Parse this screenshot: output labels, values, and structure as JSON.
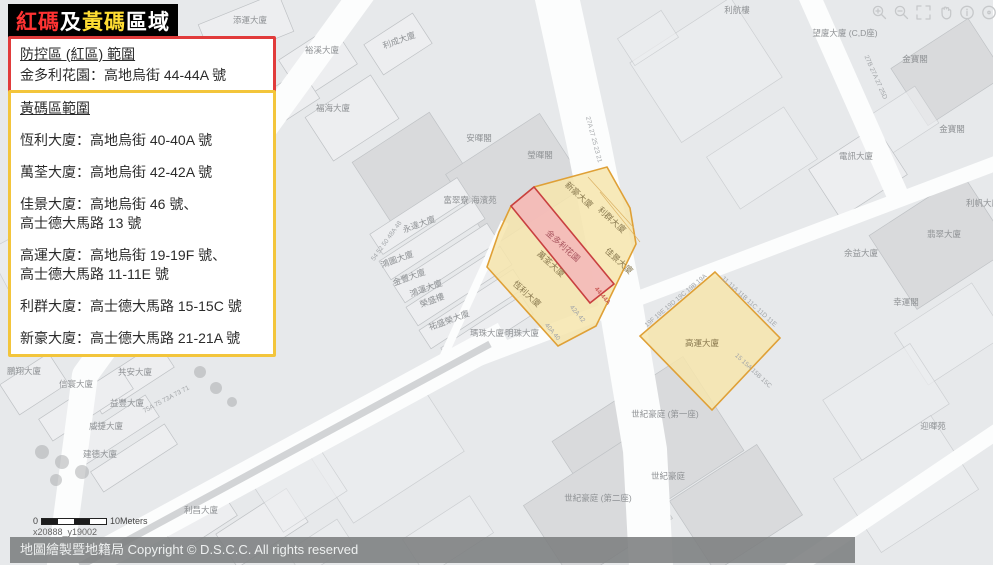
{
  "colors": {
    "map_bg": "#e7e9eb",
    "road": "#fcfdfd",
    "road_median": "#d2d4d6",
    "block": "#edeef0",
    "block_stroke": "#bfc2c5",
    "block_dark": "#d9dadc",
    "red_zone_fill": "#f3b6ba",
    "red_zone_border": "#c94040",
    "yellow_zone_fill": "#f6e5ad",
    "yellow_zone_border": "#dfa036",
    "legend_red_border": "#e13b3b",
    "legend_yellow_border": "#f3c53b",
    "title_red": "#ff3333",
    "title_yellow": "#ffdd33",
    "title_white": "#ffffff"
  },
  "title": {
    "segments": [
      {
        "text": "紅碼",
        "color": "#ff3333"
      },
      {
        "text": "及",
        "color": "#ffffff"
      },
      {
        "text": "黃碼",
        "color": "#ffdd33"
      },
      {
        "text": "區域",
        "color": "#ffffff"
      }
    ]
  },
  "legend_red": {
    "heading": "防控區 (紅區) 範圍",
    "line": "金多利花園：高地烏街 44-44A 號"
  },
  "legend_yellow": {
    "heading": "黃碼區範圍",
    "entries": [
      "恆利大廈：高地烏街 40-40A 號",
      "萬荃大廈：高地烏街 42-42A 號",
      "佳景大廈：高地烏街 46 號、\n高士德大馬路 13 號",
      "高運大廈：高地烏街 19-19F 號、\n高士德大馬路 11-11E 號",
      "利群大廈：高士德大馬路 15-15C 號",
      "新豪大廈：高士德大馬路 21-21A 號"
    ]
  },
  "toolbar": {
    "buttons": [
      "zoom-in",
      "zoom-out",
      "fullscreen",
      "pan-hand",
      "info",
      "bubble",
      "circle"
    ]
  },
  "map": {
    "labels": [
      {
        "t": "添運大廈",
        "x": 250,
        "y": 23,
        "r": 0,
        "c": "g"
      },
      {
        "t": "利成大廈",
        "x": 400,
        "y": 43,
        "r": -20,
        "c": "g"
      },
      {
        "t": "裕溪大廈",
        "x": 322,
        "y": 53,
        "r": 0,
        "c": "g"
      },
      {
        "t": "(第一,二,三期)",
        "x": 236,
        "y": 89,
        "r": 0,
        "c": "g"
      },
      {
        "t": "福海大廈",
        "x": 333,
        "y": 111,
        "r": 0,
        "c": "g"
      },
      {
        "t": "安暉閣",
        "x": 479,
        "y": 141,
        "r": 0,
        "c": "g"
      },
      {
        "t": "瑩暉閣",
        "x": 540,
        "y": 158,
        "r": 0,
        "c": "g"
      },
      {
        "t": "富翠寮 海濱苑",
        "x": 470,
        "y": 203,
        "r": 0,
        "c": "g"
      },
      {
        "t": "永達大廈",
        "x": 420,
        "y": 227,
        "r": -20,
        "c": "g"
      },
      {
        "t": "鴻圖大廈",
        "x": 398,
        "y": 262,
        "r": -20,
        "c": "g"
      },
      {
        "t": "金豐大廈",
        "x": 410,
        "y": 280,
        "r": -20,
        "c": "g"
      },
      {
        "t": "鴻運大廈",
        "x": 427,
        "y": 291,
        "r": -20,
        "c": "g"
      },
      {
        "t": "榮盛樓",
        "x": 433,
        "y": 303,
        "r": -20,
        "c": "g"
      },
      {
        "t": "祐盛榮大廈",
        "x": 450,
        "y": 323,
        "r": -20,
        "c": "g"
      },
      {
        "t": "瑪珠大廈",
        "x": 487,
        "y": 336,
        "r": 0,
        "c": "g"
      },
      {
        "t": "明珠大廈",
        "x": 522,
        "y": 336,
        "r": 0,
        "c": "g"
      },
      {
        "t": "鵬翔大廈",
        "x": 24,
        "y": 374,
        "r": 0,
        "c": "g"
      },
      {
        "t": "共安大廈",
        "x": 135,
        "y": 375,
        "r": 0,
        "c": "g"
      },
      {
        "t": "信寰大廈",
        "x": 76,
        "y": 387,
        "r": 0,
        "c": "g"
      },
      {
        "t": "益豐大廈",
        "x": 127,
        "y": 406,
        "r": 0,
        "c": "g"
      },
      {
        "t": "威捷大廈",
        "x": 106,
        "y": 429,
        "r": 0,
        "c": "g"
      },
      {
        "t": "建德大廈",
        "x": 100,
        "y": 457,
        "r": 0,
        "c": "g"
      },
      {
        "t": "利昌大廈",
        "x": 201,
        "y": 513,
        "r": 0,
        "c": "g"
      },
      {
        "t": "世紀豪庭 (第一座)",
        "x": 665,
        "y": 417,
        "r": 0,
        "c": "g"
      },
      {
        "t": "世紀豪庭",
        "x": 668,
        "y": 479,
        "r": 0,
        "c": "g"
      },
      {
        "t": "世紀豪庭 (第二座)",
        "x": 598,
        "y": 501,
        "r": 0,
        "c": "g"
      },
      {
        "t": "電訊大廈",
        "x": 856,
        "y": 159,
        "r": 0,
        "c": "g"
      },
      {
        "t": "金寶閣",
        "x": 915,
        "y": 62,
        "r": 0,
        "c": "g"
      },
      {
        "t": "金寶閣",
        "x": 952,
        "y": 132,
        "r": 0,
        "c": "g"
      },
      {
        "t": "翡翠大廈",
        "x": 944,
        "y": 237,
        "r": 0,
        "c": "g"
      },
      {
        "t": "余益大廈",
        "x": 861,
        "y": 256,
        "r": 0,
        "c": "g"
      },
      {
        "t": "幸運閣",
        "x": 906,
        "y": 305,
        "r": 0,
        "c": "g"
      },
      {
        "t": "望廈大廈 (C,D座)",
        "x": 845,
        "y": 36,
        "r": 0,
        "c": "g"
      },
      {
        "t": "利帆大廈",
        "x": 983,
        "y": 206,
        "r": 0,
        "c": "g"
      },
      {
        "t": "利航樓",
        "x": 737,
        "y": 13,
        "r": 0,
        "c": "g"
      },
      {
        "t": "迎暉苑",
        "x": 933,
        "y": 429,
        "r": 0,
        "c": "g"
      },
      {
        "t": "新豪大廈",
        "x": 577,
        "y": 197,
        "r": 42,
        "c": "z"
      },
      {
        "t": "利群大廈",
        "x": 610,
        "y": 222,
        "r": 42,
        "c": "z"
      },
      {
        "t": "佳景大廈",
        "x": 617,
        "y": 263,
        "r": 42,
        "c": "z"
      },
      {
        "t": "萬荃大廈",
        "x": 549,
        "y": 266,
        "r": 42,
        "c": "z"
      },
      {
        "t": "恆利大廈",
        "x": 525,
        "y": 296,
        "r": 42,
        "c": "z"
      },
      {
        "t": "高運大廈",
        "x": 702,
        "y": 346,
        "r": 0,
        "c": "z"
      },
      {
        "t": "金多利花園",
        "x": 561,
        "y": 248,
        "r": 42,
        "c": "r"
      },
      {
        "t": "27A 27 25 23 21",
        "x": 592,
        "y": 140,
        "r": 75,
        "c": "n"
      },
      {
        "t": "27B 27A 27 25D",
        "x": 874,
        "y": 78,
        "r": 66,
        "c": "n"
      },
      {
        "t": "54 52 50 48A 48",
        "x": 388,
        "y": 242,
        "r": -54,
        "c": "n"
      },
      {
        "t": "75A 75 73A 73 71",
        "x": 167,
        "y": 401,
        "r": -28,
        "c": "n"
      },
      {
        "t": "19F 19E 19D 19C 19B 19A",
        "x": 677,
        "y": 302,
        "r": -40,
        "c": "n"
      },
      {
        "t": "11 11A 11B 11C 11D 11E",
        "x": 748,
        "y": 303,
        "r": 42,
        "c": "n"
      },
      {
        "t": "15 15A 15B 15C",
        "x": 752,
        "y": 372,
        "r": 43,
        "c": "n"
      },
      {
        "t": "42A 42",
        "x": 576,
        "y": 315,
        "r": 50,
        "c": "n"
      },
      {
        "t": "40A 40",
        "x": 551,
        "y": 333,
        "r": 50,
        "c": "n"
      },
      {
        "t": "44-44A",
        "x": 601,
        "y": 297,
        "r": 50,
        "c": "m"
      }
    ],
    "scale": {
      "zero": "0",
      "length_label": "10Meters"
    },
    "coords_label": "x20888_y19002"
  },
  "footer": {
    "text": "地圖繪製暨地籍局 Copyright © D.S.C.C. All rights reserved"
  }
}
